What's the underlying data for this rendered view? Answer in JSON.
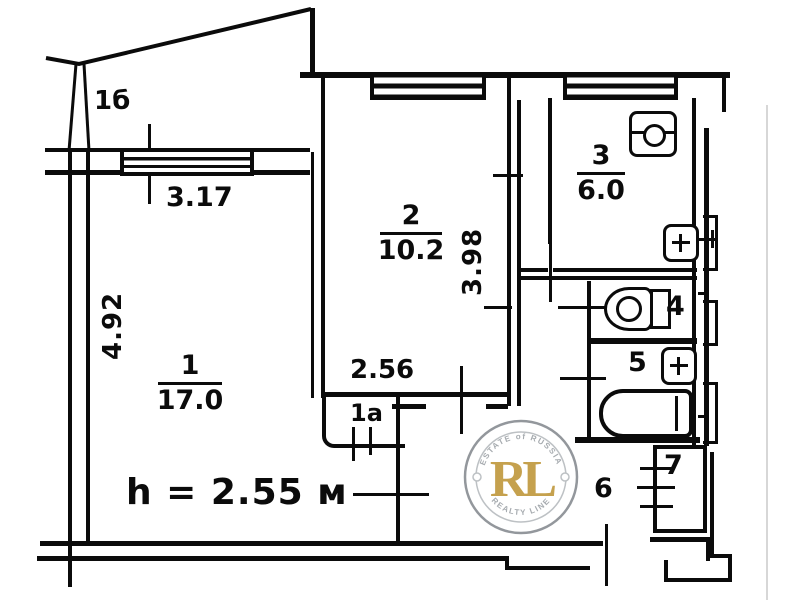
{
  "title": "Apartment floor plan (BTI drawing)",
  "rooms": {
    "room1": {
      "number": "1",
      "area": "17.0"
    },
    "room2": {
      "number": "2",
      "area": "10.2"
    },
    "kitchen": {
      "number": "3",
      "area": "6.0"
    },
    "wc": {
      "number": "4"
    },
    "bathroom": {
      "number": "5"
    },
    "hallway": {
      "number": "6"
    },
    "closet": {
      "number": "7"
    },
    "storage": {
      "number": "1а"
    },
    "balcony": {
      "number": "1б"
    }
  },
  "dimensions": {
    "balcony_window_width": "3.17",
    "room1_depth": "4.92",
    "room2_depth": "3.98",
    "room2_width": "2.56"
  },
  "notes": {
    "ceiling_height": "h = 2.55 м"
  },
  "watermark": {
    "initials": "RL",
    "arc_top": "ESTATE of RUSSIA",
    "arc_bottom": "REALTY LINE",
    "gold": "#C19A3F",
    "ring_gray": "#8a8f94",
    "text_gray": "#9fa4a9"
  }
}
